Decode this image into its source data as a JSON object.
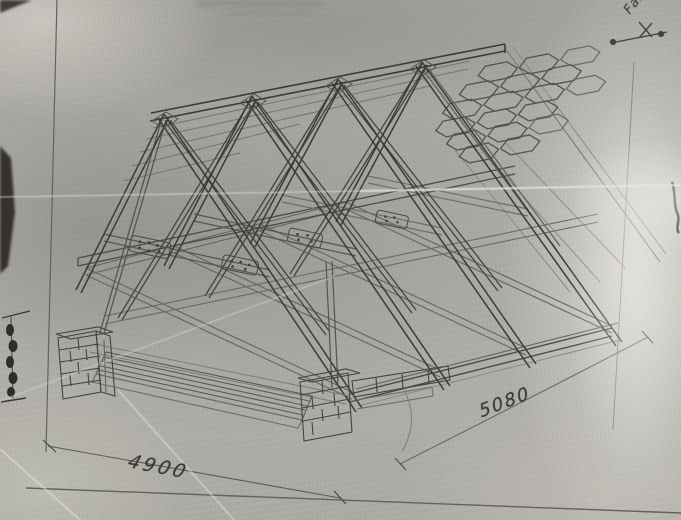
{
  "photo": {
    "description": "Pencil perspective drawing of a timber roof truss on tracing paper",
    "dimension_labels": {
      "bottom_left": "4900",
      "bottom_right": "5080"
    },
    "slope_annotation": "Fall",
    "colors": {
      "paper": "#aeaca6",
      "pencil_dark": "#3c3a36",
      "pencil_medium": "#5f5d57",
      "pencil_faint": "#85837b",
      "crease_highlight": "#dddbd4"
    }
  }
}
